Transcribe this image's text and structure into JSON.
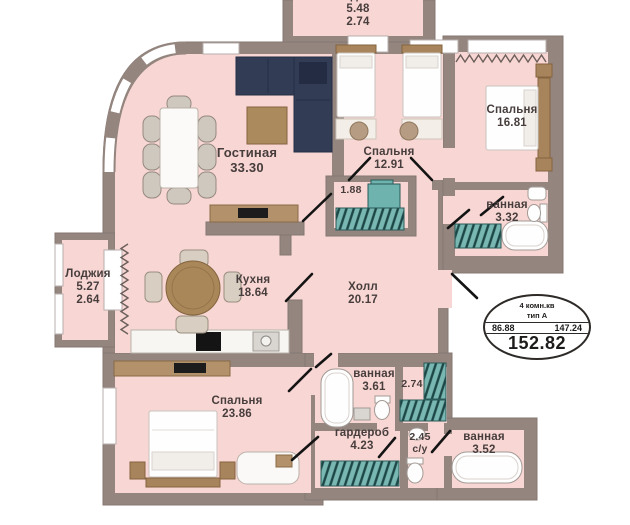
{
  "floor_plan": {
    "top_loggia": {
      "name": "Лоджия",
      "area_full": "5.48",
      "area_reduced": "2.74"
    },
    "living_room": {
      "name": "Гостиная",
      "area": "33.30"
    },
    "bedroom_top": {
      "name": "Спальня",
      "area": "12.91"
    },
    "bedroom_right": {
      "name": "Спальня",
      "area": "16.81"
    },
    "bathroom_right": {
      "name": "ванная",
      "area": "3.32"
    },
    "loggia_left": {
      "name": "Лоджия",
      "area_full": "5.27",
      "area_reduced": "2.64"
    },
    "kitchen": {
      "name": "Кухня",
      "area": "18.64"
    },
    "hall": {
      "name": "Холл",
      "area": "20.17"
    },
    "closet_hall": {
      "area": "1.88"
    },
    "bedroom_bottom": {
      "name": "Спальня",
      "area": "23.86"
    },
    "bathroom_middle": {
      "name": "ванная",
      "area": "3.61"
    },
    "closet_middle": {
      "area": "2.74"
    },
    "wardrobe": {
      "name": "гардероб",
      "area": "4.23"
    },
    "wc": {
      "area": "2.45",
      "name": "с/у"
    },
    "bathroom_bottom": {
      "name": "ванная",
      "area": "3.52"
    },
    "stamp": {
      "rooms_line": "4 комн.кв",
      "type_line": "тип A",
      "area_living": "86.88",
      "area_other": "147.24",
      "area_total": "152.82"
    },
    "colors": {
      "wall": "#94857f",
      "room_fill": "#f8d6d3",
      "teal_furniture": "#5ca7a3",
      "sofa_navy": "#323d55",
      "wood": "#ab8a5e"
    }
  }
}
